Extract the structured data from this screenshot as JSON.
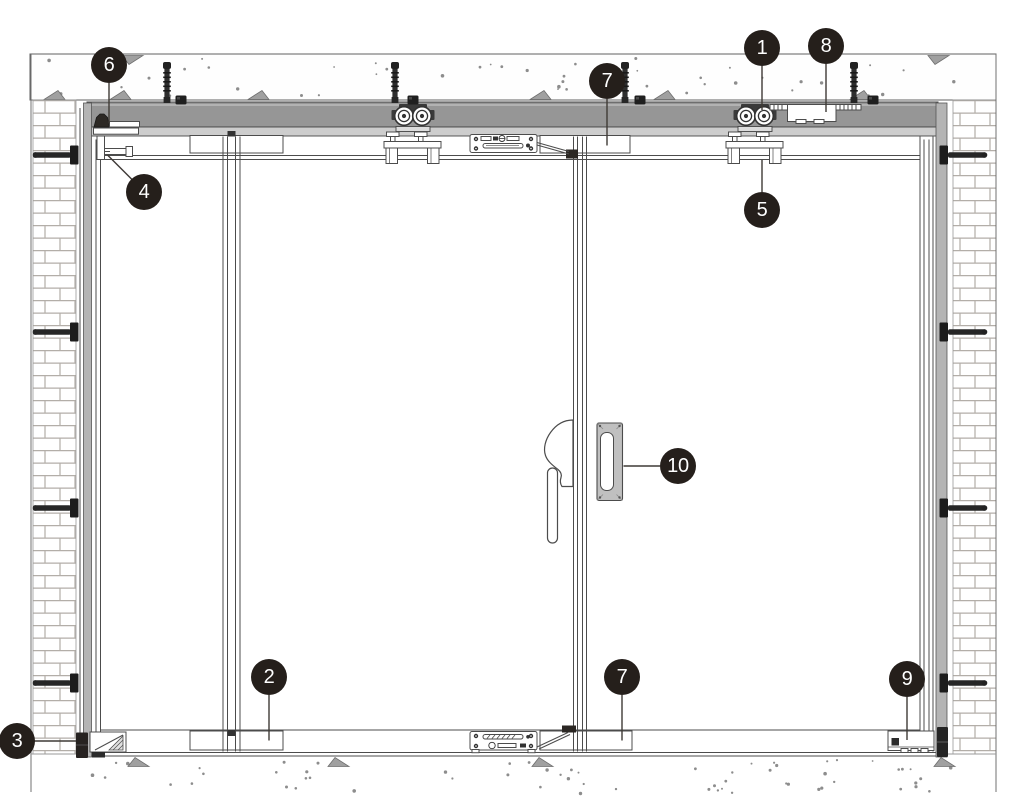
{
  "callouts": [
    {
      "id": "1",
      "label": "1"
    },
    {
      "id": "2",
      "label": "2"
    },
    {
      "id": "3",
      "label": "3"
    },
    {
      "id": "4",
      "label": "4"
    },
    {
      "id": "5",
      "label": "5"
    },
    {
      "id": "6",
      "label": "6"
    },
    {
      "id": "7-top",
      "label": "7"
    },
    {
      "id": "7-bottom",
      "label": "7"
    },
    {
      "id": "8",
      "label": "8"
    },
    {
      "id": "9",
      "label": "9"
    },
    {
      "id": "10",
      "label": "10"
    }
  ],
  "colors": {
    "callout_bg": "#251f1b",
    "callout_text": "#ffffff",
    "track_gray": "#969696",
    "fascia_gray": "#cdcdcd",
    "jamb_gray": "#b4b4b4",
    "outline": "#4c4c4c"
  }
}
